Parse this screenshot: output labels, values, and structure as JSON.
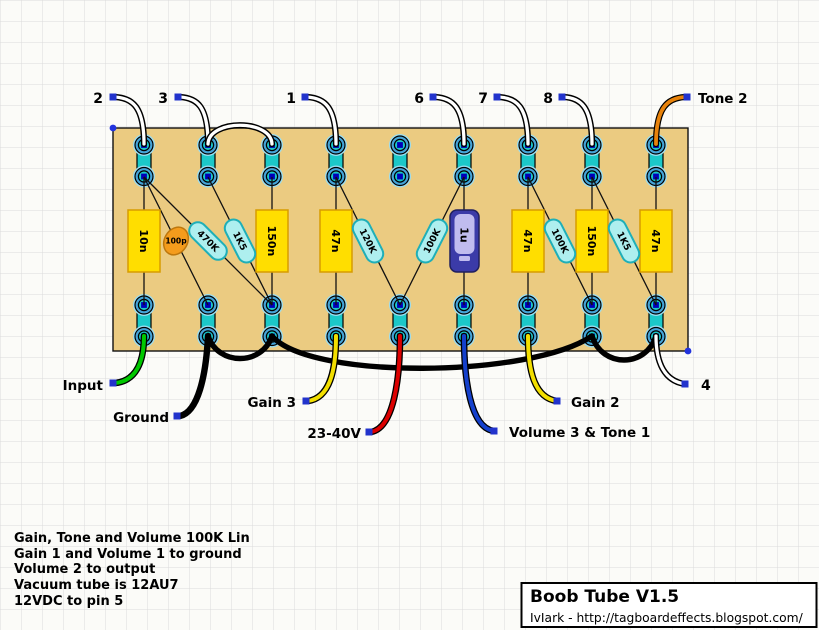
{
  "title_block": {
    "title": "Boob Tube V1.5",
    "credit": "IvIark - http://tagboardeffects.blogspot.com/"
  },
  "notes": {
    "lines": [
      "Gain, Tone and Volume 100K Lin",
      "Gain 1 and Volume 1 to ground",
      "Volume 2 to output",
      "Vacuum tube is 12AU7",
      "12VDC to pin 5"
    ]
  },
  "top_connections": {
    "pin2": "2",
    "pin3": "3",
    "pin1": "1",
    "pin6": "6",
    "pin7": "7",
    "pin8": "8",
    "tone2": "Tone 2"
  },
  "bottom_connections": {
    "input": "Input",
    "ground": "Ground",
    "gain3": "Gain 3",
    "supply": "23-40V",
    "vol3tone1": "Volume 3 & Tone 1",
    "gain2": "Gain 2",
    "pin4": "4"
  },
  "components": {
    "cap_10n": "10n",
    "cap_100p": "100p",
    "res_470k": "470K",
    "res_1k5_a": "1K5",
    "cap_150n_a": "150n",
    "cap_47n_a": "47n",
    "res_120k": "120K",
    "res_100k_a": "100K",
    "cap_1u": "1u",
    "cap_47n_b": "47n",
    "res_100k_b": "100K",
    "cap_150n_b": "150n",
    "res_1k5_b": "1K5",
    "cap_47n_c": "47n"
  },
  "colors": {
    "board": "#EBCB81",
    "strip_teal": "#1CC8C8",
    "hole_ring_blue": "#44A4D8",
    "hole_halo": "#9ADDF0",
    "hole_center_navy": "#0000B8",
    "capacitor_yellow": "#FFDE00",
    "capacitor_border": "#D89C00",
    "resistor_body": "#AEEFEF",
    "resistor_border": "#1FAFB8",
    "cap_100p_orange": "#F49C1C",
    "electrolytic_blue": "#3B3BA8",
    "electrolytic_inner": "#C0BCEF",
    "wire_green": "#00C800",
    "wire_yellow": "#F2DE00",
    "wire_red": "#DC0000",
    "wire_blue": "#1440CC",
    "wire_orange": "#E8820A",
    "wire_white": "#FFFFFF",
    "wire_black": "#000000",
    "marker_blue": "#2233CC",
    "grid_line": "#DBDBDB"
  }
}
